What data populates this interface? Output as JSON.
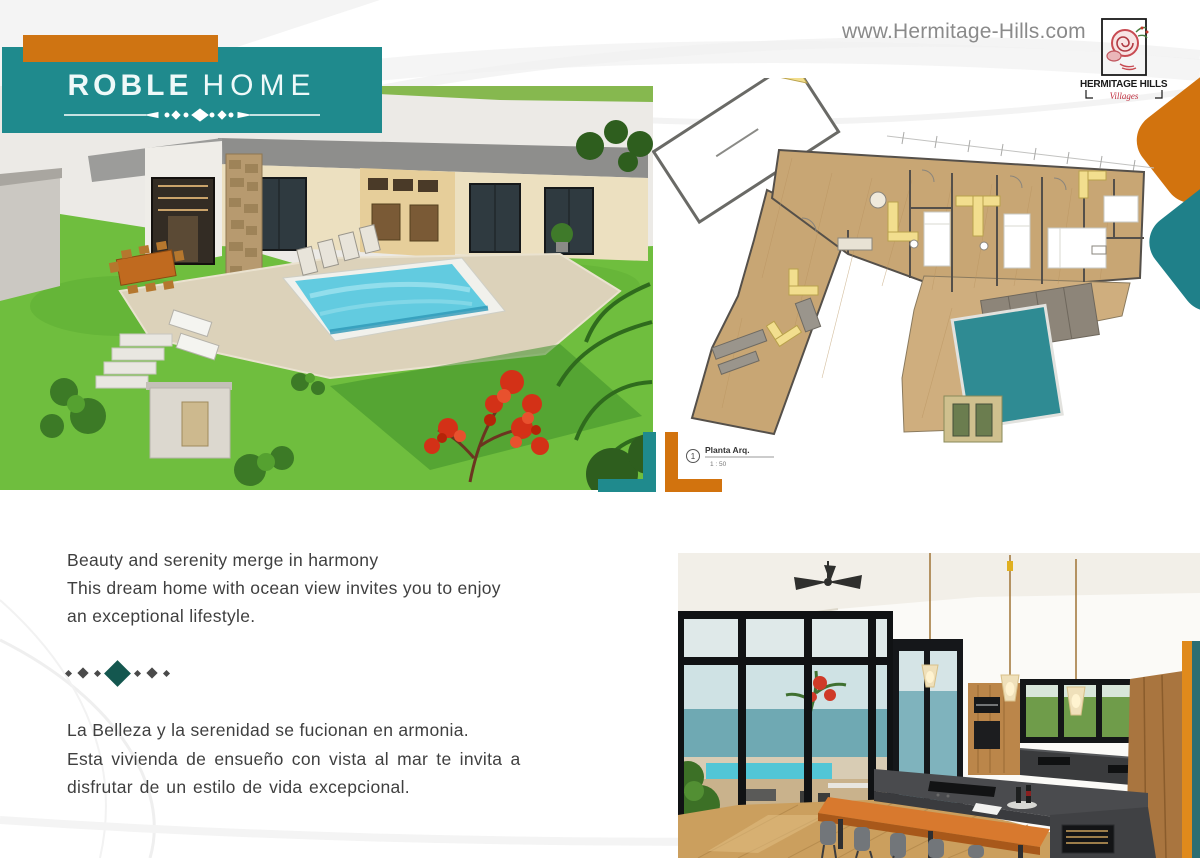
{
  "brand": {
    "title_primary": "ROBLE",
    "title_secondary": "HOME",
    "website": "www.Hermitage-Hills.com",
    "logo_name": "HERMITAGE HILLS",
    "logo_tagline": "Villages"
  },
  "colors": {
    "teal": "#1f8a8d",
    "orange": "#d2730e",
    "diamond_teal": "#14574f",
    "body_text": "#3f3f3f",
    "url_gray": "#8a8a8a"
  },
  "floor_plan": {
    "callout_number": "1",
    "callout_title": "Planta Arq.",
    "callout_scale": "1 : 50"
  },
  "description_en": {
    "line1": "Beauty and serenity merge in harmony",
    "line2": "This dream home with ocean view invites you to enjoy",
    "line3": "an exceptional lifestyle."
  },
  "description_es": {
    "line1": "La Belleza y la serenidad se fucionan en armonia.",
    "line2": "Esta vivienda de ensueño con vista al mar te invita a",
    "line3": "disfrutar de un estilo de vida excepcional."
  },
  "images": {
    "exterior_label": "exterior-pool-render",
    "floor_plan_label": "architectural-floor-plan",
    "interior_label": "kitchen-ocean-view-render"
  }
}
